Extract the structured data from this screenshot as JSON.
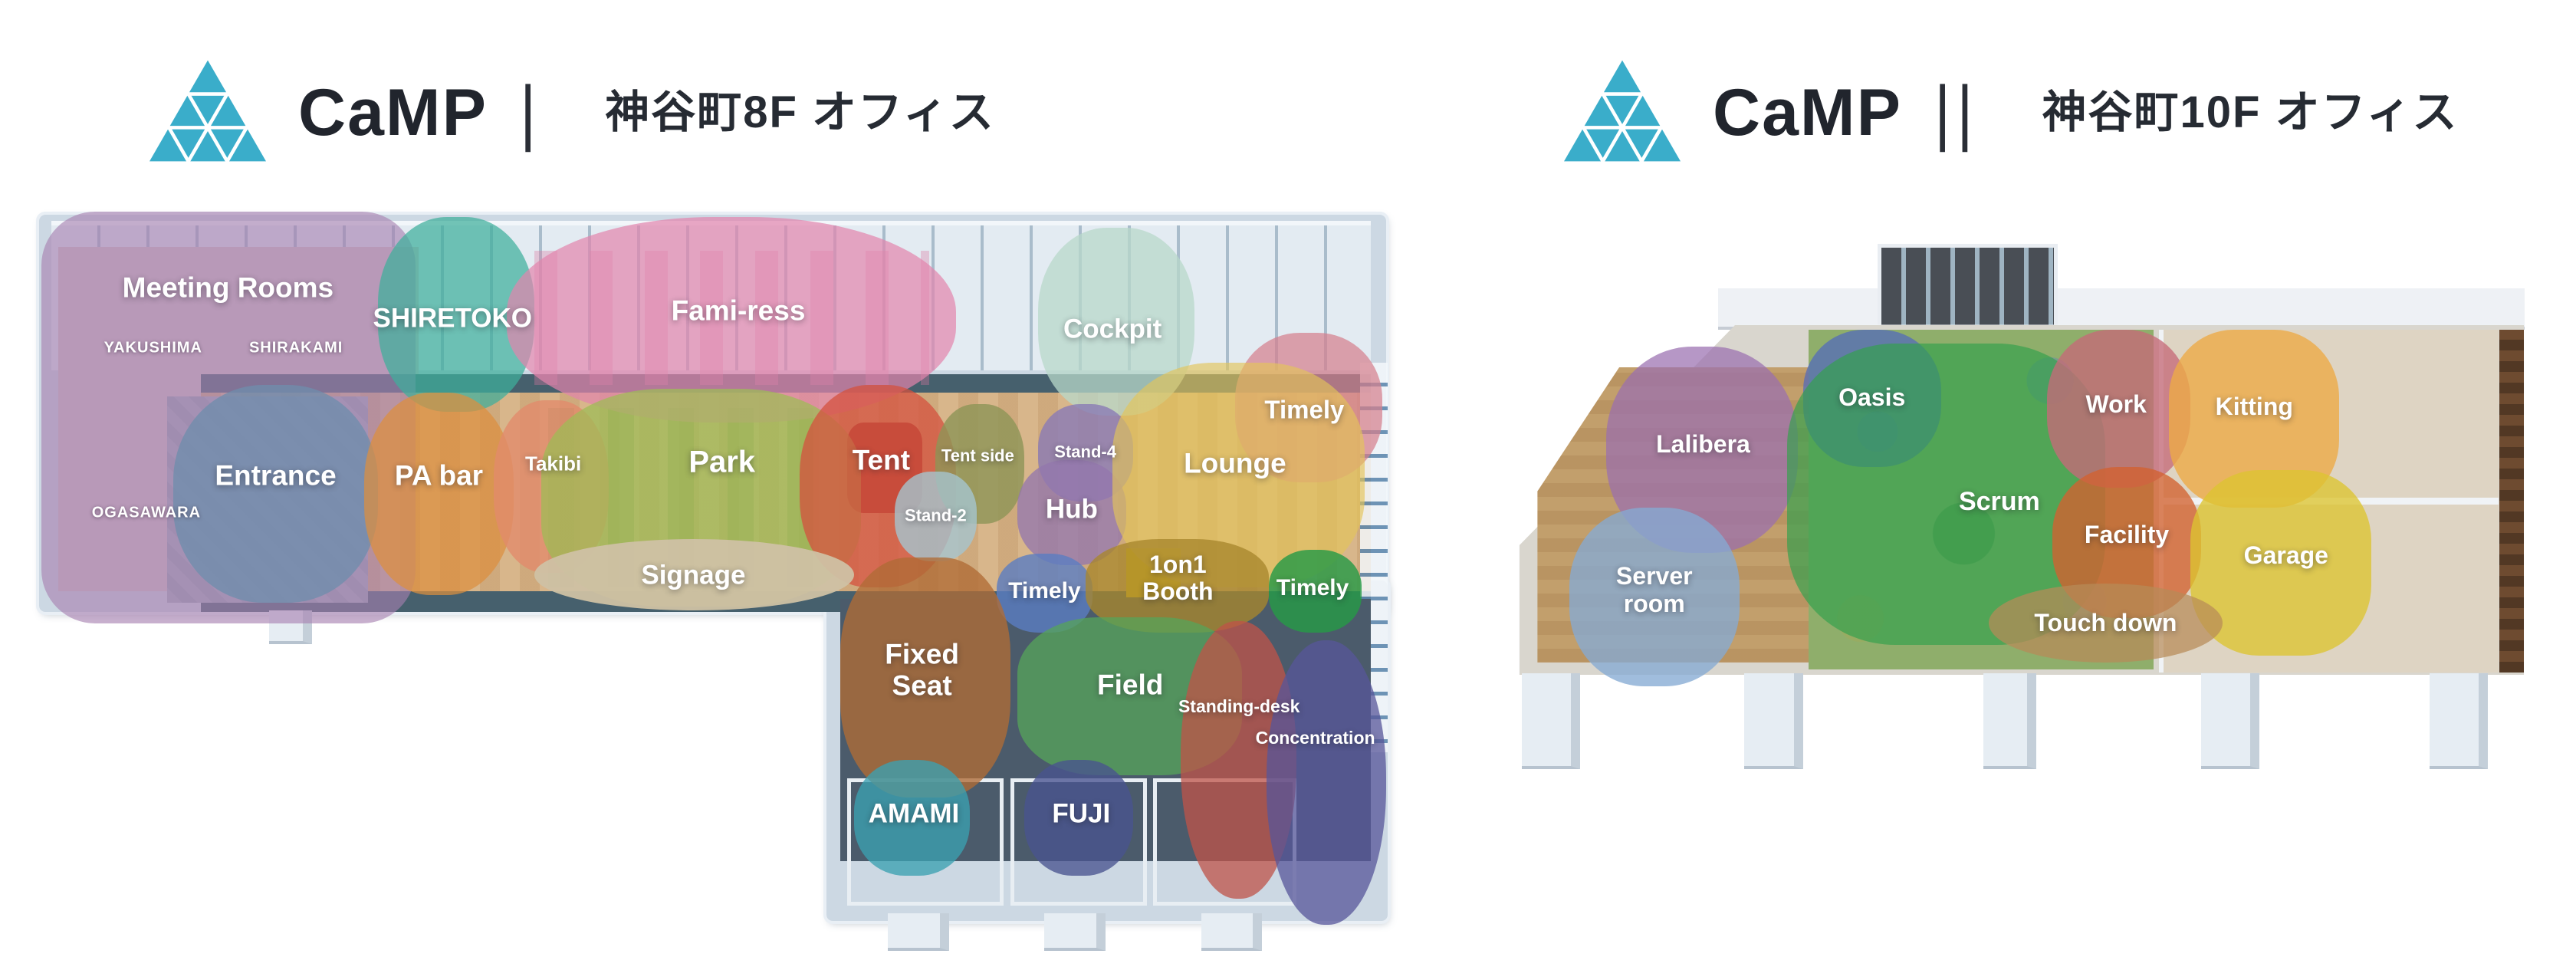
{
  "logo": {
    "icon": "triangle-mosaic-icon",
    "color": "#3aadca"
  },
  "panels": [
    {
      "name": "camp-1",
      "brand": "CaMP",
      "separator": "|",
      "title": "神谷町8F オフィス",
      "areas": [
        {
          "id": "meeting-rooms",
          "label": "Meeting Rooms",
          "color": "#a77fb0",
          "alpha": 0.62,
          "radius": "70px",
          "blob": [
            0.8,
            0.8,
            27.5,
            55
          ],
          "pos": [
            14.5,
            11
          ],
          "fs": 37
        },
        {
          "id": "shiretoko",
          "label": "SHIRETOKO",
          "color": "#3fae9b",
          "alpha": 0.72,
          "blob": [
            25.5,
            1.5,
            11.5,
            26
          ],
          "pos": [
            31,
            15
          ],
          "fs": 35
        },
        {
          "id": "fami-ress",
          "label": "Fami-ress",
          "color": "#e285ad",
          "alpha": 0.7,
          "radius": "46%",
          "blob": [
            35,
            1.5,
            33,
            27.5
          ],
          "pos": [
            52,
            14
          ],
          "fs": 37
        },
        {
          "id": "cockpit",
          "label": "Cockpit",
          "color": "#b8d8ca",
          "alpha": 0.75,
          "blob": [
            74,
            3,
            11.5,
            25
          ],
          "pos": [
            79.5,
            16.5
          ],
          "fs": 35
        },
        {
          "id": "timely-window",
          "label": "Timely",
          "color": "#d57f8d",
          "alpha": 0.72,
          "blob": [
            88.5,
            17,
            10.8,
            20
          ],
          "pos": [
            93.6,
            27.3
          ],
          "fs": 33
        },
        {
          "id": "entrance",
          "label": "Entrance",
          "color": "#6f8dac",
          "alpha": 0.78,
          "blob": [
            10.5,
            24,
            15,
            29
          ],
          "pos": [
            18,
            36
          ],
          "fs": 37
        },
        {
          "id": "pa-bar",
          "label": "PA bar",
          "color": "#dd8f3f",
          "alpha": 0.72,
          "blob": [
            24.5,
            25,
            11,
            27
          ],
          "pos": [
            30,
            36
          ],
          "fs": 37
        },
        {
          "id": "takibi",
          "label": "Takibi",
          "color": "#e18a6c",
          "alpha": 0.78,
          "blob": [
            34,
            26,
            8.5,
            23
          ],
          "pos": [
            38.4,
            34.5
          ],
          "fs": 26
        },
        {
          "id": "park",
          "label": "Park",
          "color": "#9cbd55",
          "alpha": 0.72,
          "radius": "38%",
          "blob": [
            37.5,
            24.5,
            23.5,
            29
          ],
          "pos": [
            50.8,
            34.3
          ],
          "fs": 40
        },
        {
          "id": "tent",
          "label": "Tent",
          "color": "#d4523f",
          "alpha": 0.75,
          "blob": [
            56.5,
            24,
            11.5,
            27
          ],
          "pos": [
            62.5,
            34
          ],
          "fs": 37
        },
        {
          "id": "tent-side",
          "label": "Tent side",
          "color": "#8d9556",
          "alpha": 0.8,
          "blob": [
            66.5,
            26.5,
            6.5,
            16
          ],
          "pos": [
            69.6,
            33.5
          ],
          "fs": 22
        },
        {
          "id": "stand-4",
          "label": "Stand-4",
          "color": "#8a7ab5",
          "alpha": 0.8,
          "blob": [
            74,
            26.5,
            7,
            13
          ],
          "pos": [
            77.5,
            33
          ],
          "fs": 22
        },
        {
          "id": "stand-2",
          "label": "Stand-2",
          "color": "#a5c4ce",
          "alpha": 0.8,
          "blob": [
            63.5,
            35.5,
            6,
            12
          ],
          "pos": [
            66.5,
            41.5
          ],
          "fs": 22
        },
        {
          "id": "hub",
          "label": "Hub",
          "color": "#9377ad",
          "alpha": 0.78,
          "blob": [
            72.5,
            34,
            8,
            14
          ],
          "pos": [
            76.5,
            40.5
          ],
          "fs": 35
        },
        {
          "id": "lounge",
          "label": "Lounge",
          "color": "#e3c459",
          "alpha": 0.65,
          "radius": "40%",
          "blob": [
            79.5,
            21,
            18.5,
            30
          ],
          "pos": [
            88.5,
            34.4
          ],
          "fs": 37
        },
        {
          "id": "signage",
          "label": "Signage",
          "color": "#cfc1a4",
          "alpha": 0.95,
          "radius": "50%",
          "blob": [
            37,
            44.5,
            23.5,
            9.5
          ],
          "pos": [
            48.7,
            49.3
          ],
          "fs": 35
        },
        {
          "id": "timely-booth-blue",
          "label": "Timely",
          "color": "#5a7dc2",
          "alpha": 0.8,
          "blob": [
            71,
            46.5,
            7,
            10.5
          ],
          "pos": [
            74.5,
            51.5
          ],
          "fs": 30
        },
        {
          "id": "one-on-one-booth",
          "label": "1on1\nBooth",
          "color": "#a8862d",
          "alpha": 0.78,
          "radius": "40%",
          "blob": [
            77.5,
            44.5,
            13.5,
            12.5
          ],
          "pos": [
            84.3,
            49.8
          ],
          "fs": 32
        },
        {
          "id": "timely-booth-green",
          "label": "Timely",
          "color": "#279a47",
          "alpha": 0.82,
          "blob": [
            91,
            46,
            6.8,
            11
          ],
          "pos": [
            94.2,
            51.1
          ],
          "fs": 30
        },
        {
          "id": "fixed-seat",
          "label": "Fixed\nSeat",
          "color": "#b06c36",
          "alpha": 0.78,
          "radius": "40%",
          "blob": [
            59.5,
            47,
            12.5,
            32
          ],
          "pos": [
            65.5,
            62
          ],
          "fs": 37
        },
        {
          "id": "field",
          "label": "Field",
          "color": "#55a45a",
          "alpha": 0.75,
          "radius": "36%",
          "blob": [
            72.5,
            55,
            16.5,
            21
          ],
          "pos": [
            80.8,
            64
          ],
          "fs": 37
        },
        {
          "id": "standing-desk",
          "label": "Standing-desk",
          "color": "#bf5348",
          "alpha": 0.75,
          "radius": "48%",
          "blob": [
            84.5,
            55.5,
            8.5,
            37
          ],
          "pos": [
            88.8,
            66.9
          ],
          "fs": 23
        },
        {
          "id": "concentration",
          "label": "Concentration",
          "color": "#57569a",
          "alpha": 0.75,
          "radius": "48%",
          "blob": [
            90.8,
            58,
            8.8,
            38
          ],
          "pos": [
            94.4,
            71.1
          ],
          "fs": 23
        },
        {
          "id": "amami",
          "label": "AMAMI",
          "color": "#3ba0b1",
          "alpha": 0.78,
          "blob": [
            60.5,
            74,
            8.5,
            15.5
          ],
          "pos": [
            64.9,
            81.2
          ],
          "fs": 35
        },
        {
          "id": "fuji",
          "label": "FUJI",
          "color": "#49538f",
          "alpha": 0.78,
          "blob": [
            73,
            74,
            8,
            15.5
          ],
          "pos": [
            77.2,
            81.2
          ],
          "fs": 35
        }
      ],
      "sublabels": [
        {
          "id": "yakushima",
          "label": "YAKUSHIMA",
          "pos": [
            9,
            19
          ],
          "fs": 20
        },
        {
          "id": "shirakami",
          "label": "SHIRAKAMI",
          "pos": [
            19.5,
            19
          ],
          "fs": 20
        },
        {
          "id": "ogasawara",
          "label": "OGASAWARA",
          "pos": [
            8.5,
            41
          ],
          "fs": 20
        }
      ]
    },
    {
      "name": "camp-2",
      "brand": "CaMP",
      "separator": "||",
      "title": "神谷町10F オフィス",
      "areas": [
        {
          "id": "lalibera",
          "label": "Lalibera",
          "color": "#9a6fb0",
          "alpha": 0.72,
          "radius": "45%",
          "blob": [
            10.5,
            17,
            18,
            30
          ],
          "pos": [
            19.6,
            31.3
          ],
          "fs": 32
        },
        {
          "id": "server-room",
          "label": "Server\nroom",
          "color": "#85abd3",
          "alpha": 0.78,
          "blob": [
            7,
            40.5,
            16,
            26
          ],
          "pos": [
            15,
            52.5
          ],
          "fs": 32
        },
        {
          "id": "oasis",
          "label": "Oasis",
          "color": "#5069bd",
          "alpha": 0.72,
          "blob": [
            29,
            14.5,
            13,
            20
          ],
          "pos": [
            35.5,
            24.5
          ],
          "fs": 32
        },
        {
          "id": "scrum",
          "label": "Scrum",
          "color": "#33a04c",
          "alpha": 0.68,
          "radius": "34%",
          "blob": [
            27.5,
            16.5,
            30,
            44
          ],
          "pos": [
            47.5,
            39.5
          ],
          "fs": 34
        },
        {
          "id": "work",
          "label": "Work",
          "color": "#c56a78",
          "alpha": 0.78,
          "blob": [
            52,
            14.5,
            13.5,
            23
          ],
          "pos": [
            58.5,
            25.5
          ],
          "fs": 32
        },
        {
          "id": "facility",
          "label": "Facility",
          "color": "#d2622f",
          "alpha": 0.78,
          "blob": [
            52.5,
            34.5,
            14,
            22
          ],
          "pos": [
            59.5,
            44.5
          ],
          "fs": 32
        },
        {
          "id": "kitting",
          "label": "Kitting",
          "color": "#ecaa47",
          "alpha": 0.8,
          "radius": "38%",
          "blob": [
            63.5,
            14.5,
            16,
            26
          ],
          "pos": [
            71.5,
            25.8
          ],
          "fs": 32
        },
        {
          "id": "garage",
          "label": "Garage",
          "color": "#ddc431",
          "alpha": 0.78,
          "radius": "38%",
          "blob": [
            65.5,
            35,
            17,
            27
          ],
          "pos": [
            74.5,
            47.5
          ],
          "fs": 32
        },
        {
          "id": "touch-down",
          "label": "Touch down",
          "color": "#b78b58",
          "alpha": 0.72,
          "radius": "50%",
          "blob": [
            46.5,
            51.5,
            22,
            11.5
          ],
          "pos": [
            57.5,
            57.3
          ],
          "fs": 32
        }
      ],
      "sublabels": []
    }
  ]
}
